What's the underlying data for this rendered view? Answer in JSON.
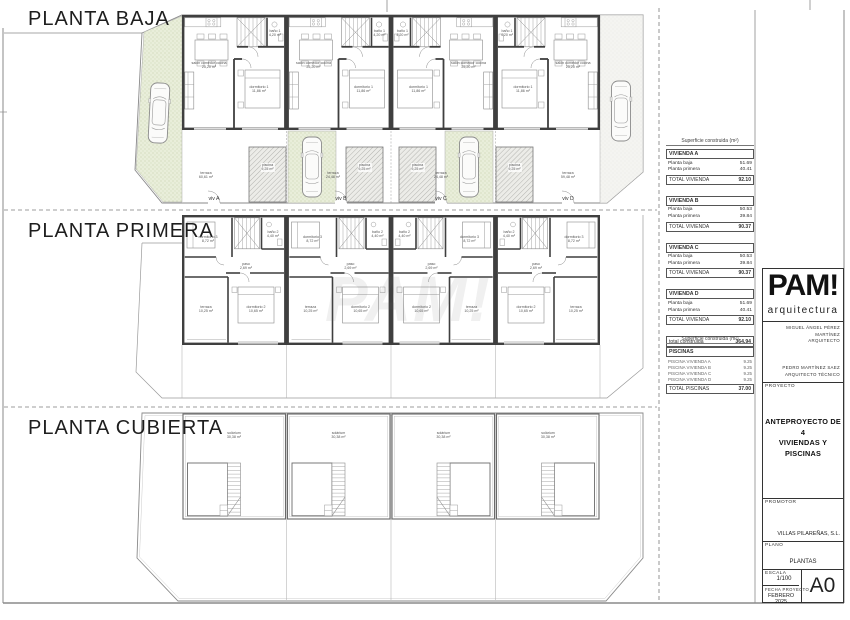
{
  "sections": {
    "baja": "PLANTA BAJA",
    "primera": "PLANTA PRIMERA",
    "cubierta": "PLANTA CUBIERTA"
  },
  "watermark": "PAM!",
  "plans": {
    "baja": {
      "strip_top": 15,
      "unit_width": 104.5,
      "units": [
        {
          "id": "A",
          "x": 182,
          "mirror": false
        },
        {
          "id": "B",
          "x": 286.5,
          "mirror": false
        },
        {
          "id": "C",
          "x": 391,
          "mirror": true
        },
        {
          "id": "D",
          "x": 495.5,
          "mirror": true
        }
      ],
      "room_labels": [
        {
          "lines": [
            "salón comedor cocina",
            "25,20 m²"
          ],
          "x": 27,
          "y": 46
        },
        {
          "lines": [
            "dormitorio 1",
            "11,86 m²"
          ],
          "x": 77,
          "y": 70
        },
        {
          "lines": [
            "baño 1",
            "4,20 m²"
          ],
          "x": 93,
          "y": 14
        }
      ],
      "terraza_labels": [
        {
          "lines": [
            "terraza",
            "60,61 m²"
          ],
          "x": 206,
          "y": 171
        },
        {
          "lines": [
            "terraza",
            "24,48 m²"
          ],
          "x": 333,
          "y": 171
        },
        {
          "lines": [
            "terraza",
            "24,48 m²"
          ],
          "x": 441,
          "y": 171
        },
        {
          "lines": [
            "terraza",
            "59,48 m²"
          ],
          "x": 568,
          "y": 171
        }
      ],
      "pool_label": {
        "lines": [
          "piscina",
          "9,25 m²"
        ]
      },
      "pools_x": [
        249,
        346,
        399,
        496
      ],
      "pool_y": 147,
      "viv_labels": [
        {
          "text": "viv A",
          "x": 214,
          "y": 196
        },
        {
          "text": "viv B",
          "x": 341,
          "y": 196
        },
        {
          "text": "viv C",
          "x": 441,
          "y": 196
        },
        {
          "text": "viv D",
          "x": 568,
          "y": 196
        }
      ]
    },
    "primera": {
      "strip_top": 215,
      "unit_width": 104.5,
      "units": [
        {
          "id": "A",
          "x": 182,
          "mirror": false
        },
        {
          "id": "B",
          "x": 286.5,
          "mirror": false
        },
        {
          "id": "C",
          "x": 391,
          "mirror": true
        },
        {
          "id": "D",
          "x": 495.5,
          "mirror": true
        }
      ],
      "room_labels": [
        {
          "lines": [
            "dormitorio 3",
            "8,72 m²"
          ],
          "x": 26,
          "y": 20
        },
        {
          "lines": [
            "baño 2",
            "4,40 m²"
          ],
          "x": 91,
          "y": 15
        },
        {
          "lines": [
            "paso",
            "2,69 m²"
          ],
          "x": 64,
          "y": 47
        },
        {
          "lines": [
            "terraza",
            "10,25 m²"
          ],
          "x": 24,
          "y": 90
        },
        {
          "lines": [
            "dormitorio 2",
            "10,65 m²"
          ],
          "x": 74,
          "y": 90
        }
      ]
    },
    "cubierta": {
      "strip_top": 413,
      "unit_width": 104.5,
      "units": [
        {
          "id": "A",
          "x": 182,
          "mirror": false
        },
        {
          "id": "B",
          "x": 286.5,
          "mirror": false
        },
        {
          "id": "C",
          "x": 391,
          "mirror": true
        },
        {
          "id": "D",
          "x": 495.5,
          "mirror": true
        }
      ],
      "room_labels": [
        {
          "lines": [
            "solárium",
            "30,38 m²"
          ],
          "x": 52,
          "y": 18
        }
      ]
    }
  },
  "area_table": {
    "header": "Superficie construida (m²)",
    "groups": [
      {
        "title": "VIVIENDA A",
        "rows": [
          [
            "Planta baja",
            "51.69"
          ],
          [
            "Planta primera",
            "40.41"
          ]
        ],
        "total": [
          "TOTAL VIVIENDA",
          "92.10"
        ]
      },
      {
        "title": "VIVIENDA B",
        "rows": [
          [
            "Planta baja",
            "50.53"
          ],
          [
            "Planta primera",
            "39.84"
          ]
        ],
        "total": [
          "TOTAL VIVIENDA",
          "90.37"
        ]
      },
      {
        "title": "VIVIENDA C",
        "rows": [
          [
            "Planta baja",
            "50.53"
          ],
          [
            "Planta primera",
            "39.84"
          ]
        ],
        "total": [
          "TOTAL VIVIENDA",
          "90.37"
        ]
      },
      {
        "title": "VIVIENDA D",
        "rows": [
          [
            "Planta baja",
            "51.69"
          ],
          [
            "Planta primera",
            "40.41"
          ]
        ],
        "total": [
          "TOTAL VIVIENDA",
          "92.10"
        ]
      }
    ],
    "grand_total": [
      "total construida",
      "364.94"
    ]
  },
  "pool_table": {
    "header": "Superficie construida (m²)",
    "title": "PISCINAS",
    "rows": [
      [
        "PISCINA VIVIENDA A",
        "9.25"
      ],
      [
        "PISCINA VIVIENDA B",
        "9.25"
      ],
      [
        "PISCINA VIVIENDA C",
        "9.25"
      ],
      [
        "PISCINA VIVIENDA D",
        "9.25"
      ]
    ],
    "total": [
      "TOTAL PISCINAS",
      "37.00"
    ]
  },
  "titleblock": {
    "logo": "PAM!",
    "logo_sub": "arquitectura",
    "architect_name": "MIGUEL ÁNGEL PÉREZ MARTÍNEZ",
    "architect_role": "ARQUITECTO",
    "technical_name": "PEDRO MARTÍNEZ SAEZ",
    "technical_role": "ARQUITECTO TÉCNICO",
    "proyecto_label": "PROYECTO",
    "proyecto": "ANTEPROYECTO DE  4\nVIVIENDAS Y PISCINAS",
    "promotor_label": "PROMOTOR",
    "promotor": "VILLAS PILAREÑAS, S.L.",
    "plano_label": "PLANO",
    "plano": "PLANTAS",
    "escala_label": "ESCALA",
    "escala": "1/100",
    "fecha_label": "FECHA PROYECTO",
    "fecha": "FEBRERO 2025",
    "sheet_size": "A0"
  }
}
